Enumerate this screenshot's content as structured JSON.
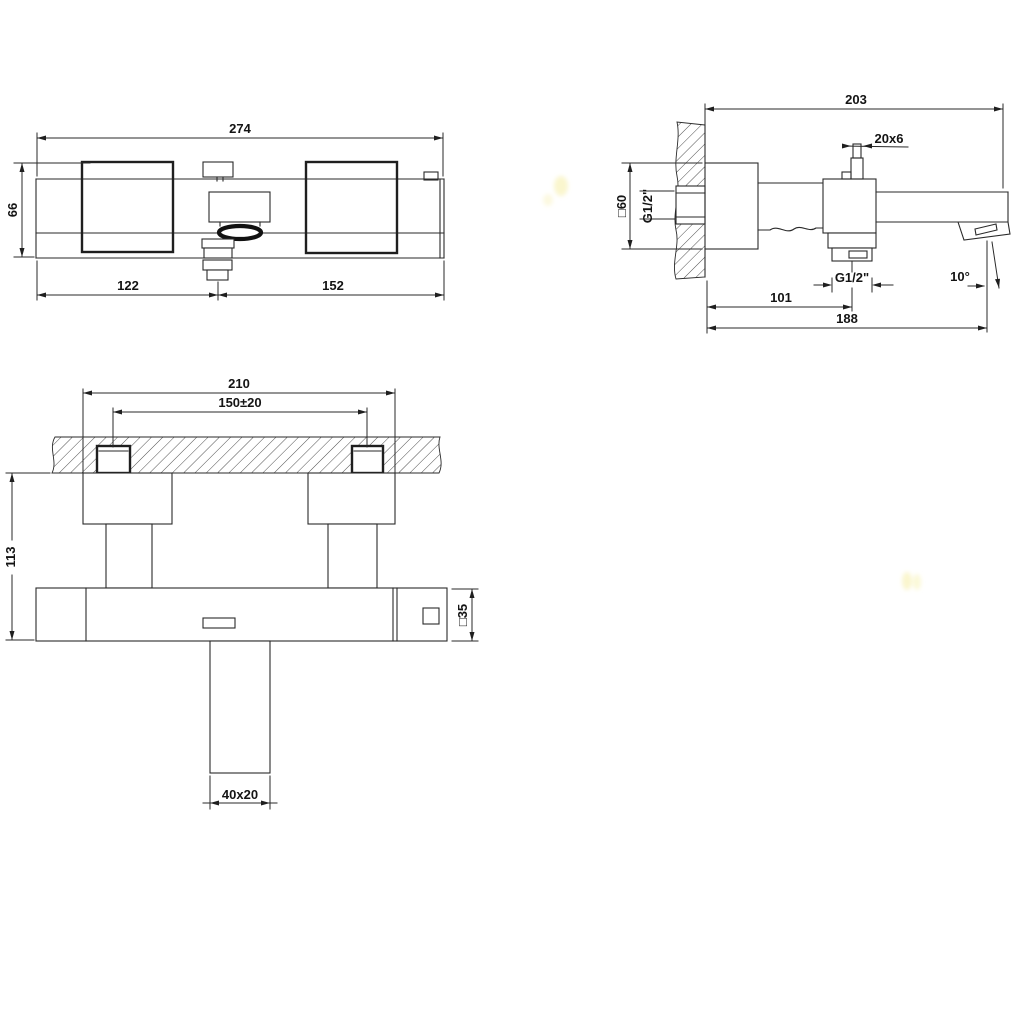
{
  "meta": {
    "background": "#ffffff",
    "line_color": "#2a2a2a",
    "watermark_color": "#f6efa6"
  },
  "dimensions": {
    "top_view": {
      "overall_width": "274",
      "body_depth": "66",
      "spout_center_from_left": "122",
      "spout_center_to_right": "152"
    },
    "side_view": {
      "wall_to_spout_end": "203",
      "handle_section": "20x6",
      "wall_plate_square": "□60",
      "inlet_thread": "G1/2\"",
      "handshower_thread": "G1/2\"",
      "wall_to_handshower_axis": "101",
      "wall_to_outlet_axis": "188",
      "outlet_angle": "10°"
    },
    "front_view": {
      "overall_width": "210",
      "inlet_centers": "150±20",
      "wall_to_body_bottom": "113",
      "body_square": "□35",
      "spout_section": "40x20"
    }
  }
}
